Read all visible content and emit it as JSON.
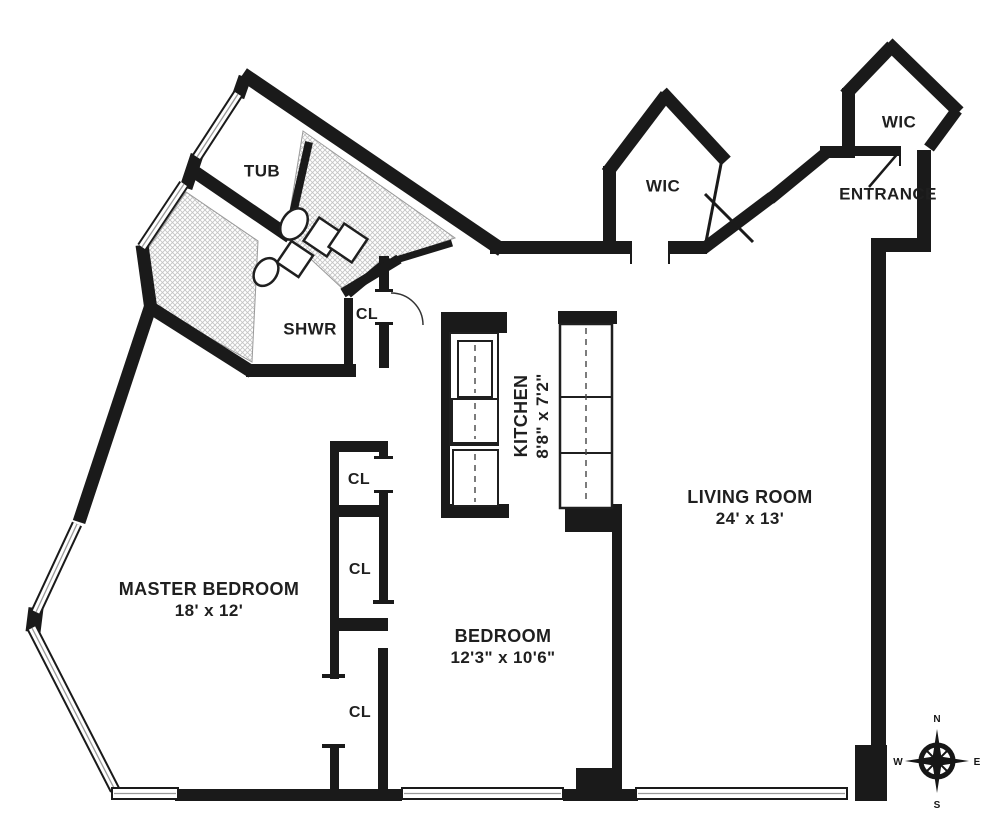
{
  "floorplan": {
    "tub": {
      "label": "TUB"
    },
    "shower": {
      "label": "SHWR"
    },
    "closets": [
      {
        "label": "CL"
      },
      {
        "label": "CL"
      },
      {
        "label": "CL"
      },
      {
        "label": "CL"
      }
    ],
    "wics": [
      {
        "label": "WIC"
      },
      {
        "label": "WIC"
      }
    ],
    "entrance": {
      "label": "ENTRANCE"
    },
    "kitchen": {
      "name": "KITCHEN",
      "dims": "8'8\" x 7'2\""
    },
    "living_room": {
      "name": "LIVING ROOM",
      "dims": "24' x 13'"
    },
    "master_bedroom": {
      "name": "MASTER BEDROOM",
      "dims": "18' x 12'"
    },
    "bedroom": {
      "name": "BEDROOM",
      "dims": "12'3\" x 10'6\""
    },
    "compass": {
      "n": "N",
      "e": "E",
      "s": "S",
      "w": "W"
    },
    "colors": {
      "wall": "#1a1a1a",
      "background": "#ffffff",
      "tile_hatch": "#c4c4c4"
    }
  }
}
